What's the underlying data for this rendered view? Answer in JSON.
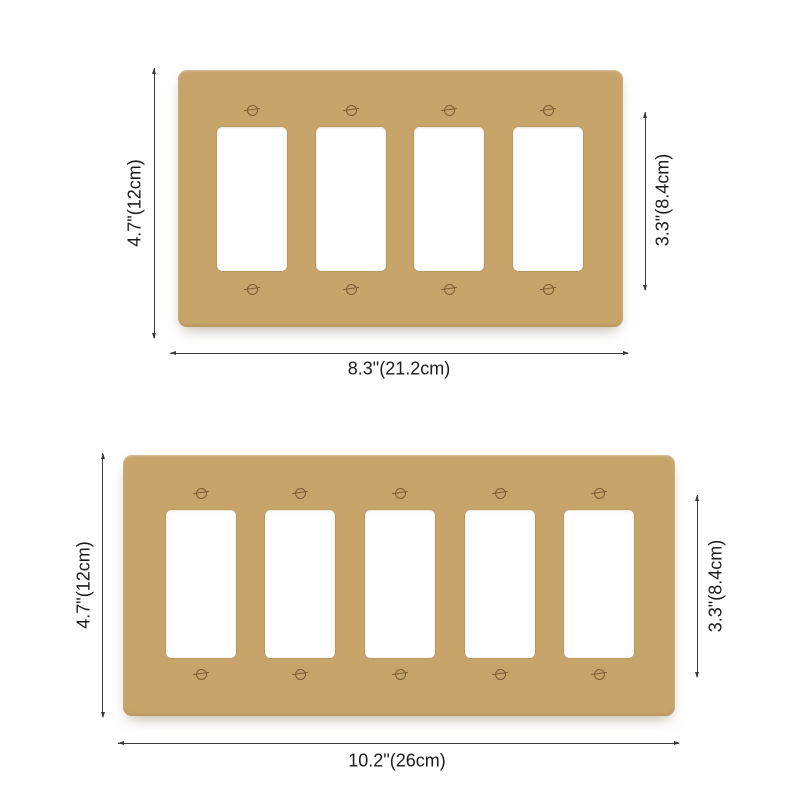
{
  "colors": {
    "plate_gold": "#c7a56a",
    "plate_gold_dark": "#b5925a",
    "screw_brown": "#7a5c33",
    "dimension_line": "#3a3a3a",
    "label_text": "#1c1c1c",
    "opening_white": "#ffffff",
    "background": "#ffffff"
  },
  "plates": [
    {
      "id": "four-gang-wall-plate",
      "gang_count": 4,
      "screw_count": 8,
      "height_label": "4.7\"(12cm)",
      "opening_height_label": "3.3\"(8.4cm)",
      "width_label": "8.3\"(21.2cm)"
    },
    {
      "id": "five-gang-wall-plate",
      "gang_count": 5,
      "screw_count": 10,
      "height_label": "4.7\"(12cm)",
      "opening_height_label": "3.3\"(8.4cm)",
      "width_label": "10.2\"(26cm)"
    }
  ]
}
